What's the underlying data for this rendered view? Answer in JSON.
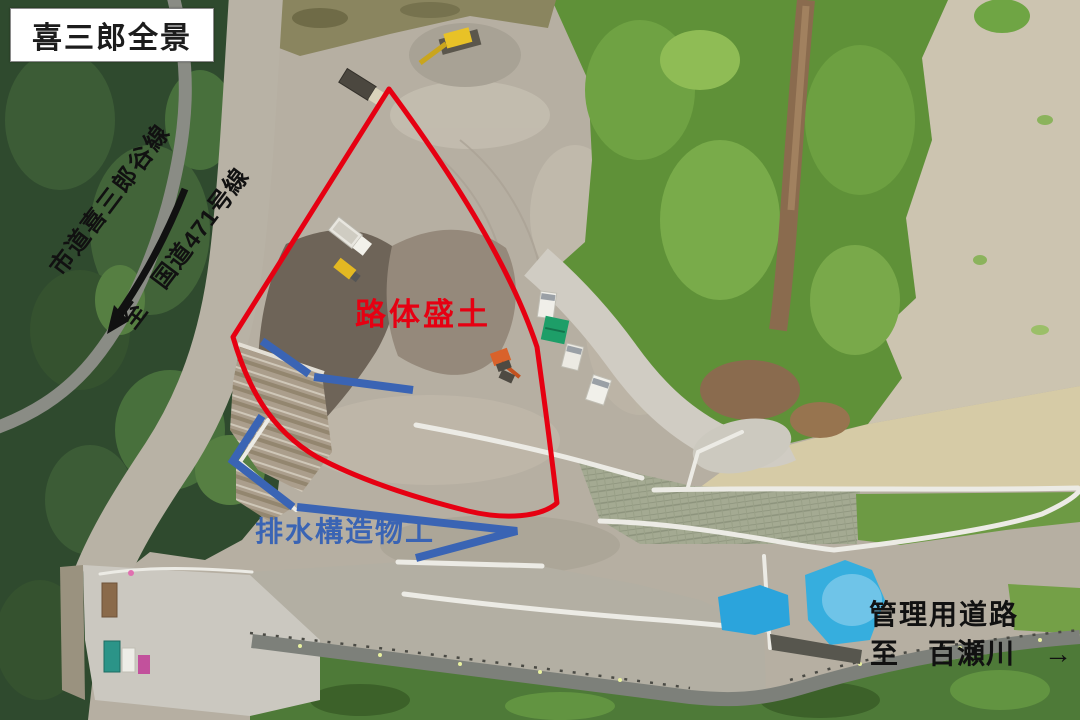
{
  "title": {
    "text": "喜三郎全景"
  },
  "annotations": {
    "city_road": {
      "text": "市道喜三郎谷線",
      "color": "#111111"
    },
    "route471": {
      "text": "至　国道471号線",
      "color": "#111111"
    },
    "embankment": {
      "text": "路体盛土",
      "color": "#e60012"
    },
    "drainage": {
      "text": "排水構造物工",
      "color": "#3a64b4"
    },
    "management_road": {
      "text": "管理用道路",
      "color": "#111111"
    },
    "destination": {
      "text": "至　百瀬川　→",
      "color": "#111111"
    }
  },
  "overlay_colors": {
    "embankment_outline": "#e60012",
    "drainage_lines": "#3a64b4",
    "direction_arrow": "#111111",
    "blue_tarp": "#2ba4dc",
    "green_tarp": "#1d9e68"
  }
}
